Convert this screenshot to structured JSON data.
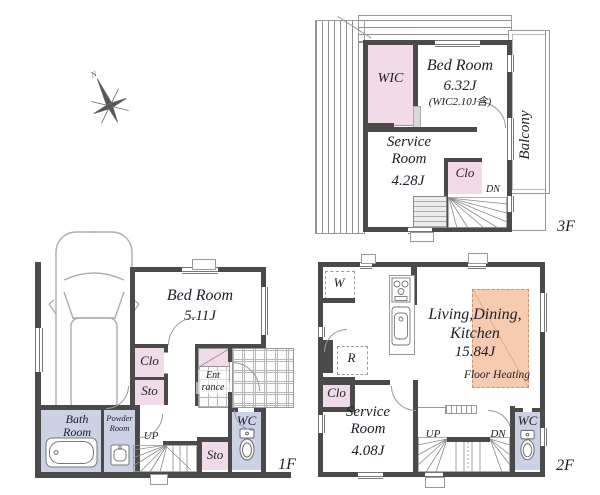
{
  "colors": {
    "wall": "#4a4a4a",
    "closet_pink": "#f2dbe9",
    "sanitary_lavender": "#ccd1e6",
    "floor_heating_peach": "#f6cbb0"
  },
  "compass": {
    "north_label": "N"
  },
  "f3": {
    "floor_label": "3F",
    "wic_label": "WIC",
    "bedroom_name": "Bed Room",
    "bedroom_size": "6.32J",
    "bedroom_note": "(WIC2.10J含)",
    "balcony_label": "Balcony",
    "service_room_name": "Service Room",
    "service_room_size": "4.28J",
    "closet_label": "Clo",
    "down_label": "DN"
  },
  "f1": {
    "floor_label": "1F",
    "bedroom_name": "Bed Room",
    "bedroom_size": "5.11J",
    "closet_label": "Clo",
    "storage_label": "Sto",
    "entrance_line1": "Ent",
    "entrance_line2": "rance",
    "bathroom_name": "Bath Room",
    "powder_room_name": "Powder Room",
    "up_label": "UP",
    "storage2_label": "Sto",
    "wc_label": "WC"
  },
  "f2": {
    "floor_label": "2F",
    "washer_label": "W",
    "fridge_label": "R",
    "ldk_line1": "Living,Dining,",
    "ldk_line2": "Kitchen",
    "ldk_size": "15.84J",
    "floor_heating_label": "Floor Heating",
    "closet_label": "Clo",
    "service_room_name": "Service Room",
    "service_room_size": "4.08J",
    "up_label": "UP",
    "down_label": "DN",
    "wc_label": "WC"
  }
}
